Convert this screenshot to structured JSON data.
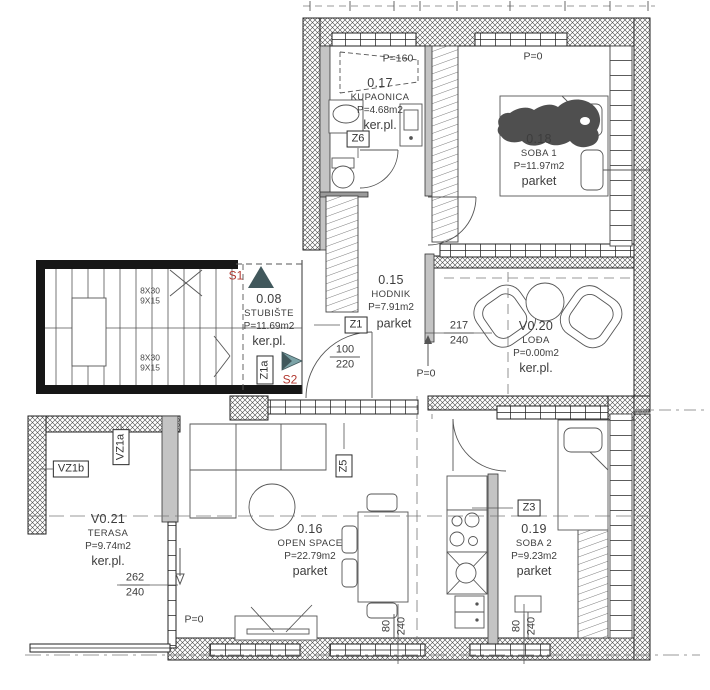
{
  "drawing": {
    "type": "apartment-floor-plan"
  },
  "rooms": {
    "kupaonica": {
      "id": "0.17",
      "name": "KUPAONICA",
      "area": "P=4.68m2",
      "floor": "ker.pl."
    },
    "soba1": {
      "id": "0.18",
      "name": "SOBA 1",
      "area": "P=11.97m2",
      "floor": "parket"
    },
    "hodnik": {
      "id": "0.15",
      "name": "HODNIK",
      "area": "P=7.91m2",
      "floor": "parket"
    },
    "stubiste": {
      "id": "0.08",
      "name": "STUBIŠTE",
      "area": "P=11.69m2",
      "floor": "ker.pl."
    },
    "lodja": {
      "id": "V0.20",
      "name": "LOĐA",
      "area": "P=0.00m2",
      "floor": "ker.pl."
    },
    "terasa": {
      "id": "V0.21",
      "name": "TERASA",
      "area": "P=9.74m2",
      "floor": "ker.pl."
    },
    "open_space": {
      "id": "0.16",
      "name": "OPEN SPACE",
      "area": "P=22.79m2",
      "floor": "parket"
    },
    "soba2": {
      "id": "0.19",
      "name": "SOBA 2",
      "area": "P=9.23m2",
      "floor": "parket"
    }
  },
  "door_tags": {
    "z1": "Z1",
    "z1a": "Z1a",
    "z3": "Z3",
    "z5": "Z5",
    "z6": "Z6",
    "vz1a": "VZ1a",
    "vz1b": "VZ1b"
  },
  "parapets": {
    "kupaonica": "P=160",
    "soba1": "P=0",
    "hodnik": "P=0",
    "open_space": "P=0"
  },
  "stairs": {
    "s1": "S1",
    "s2": "S2",
    "flight1_rise": "8X30",
    "flight1_run": "9X15",
    "flight2_rise": "8X30",
    "flight2_run": "9X15"
  },
  "dimensions": {
    "hodnik_door": {
      "w": "100",
      "h": "220"
    },
    "lodja_opening": {
      "w": "217",
      "h": "240"
    },
    "terasa_opening": {
      "w": "262",
      "h": "240"
    },
    "open_space_window": {
      "w": "80",
      "h": "240"
    },
    "soba2_window": {
      "w": "80",
      "h": "240"
    }
  },
  "colors": {
    "marker_red": "#b23a32",
    "arrow_dark": "#41585c",
    "arrow_light": "#7ca3a7",
    "wall_gray": "#c4c4c4",
    "line": "#222222"
  }
}
